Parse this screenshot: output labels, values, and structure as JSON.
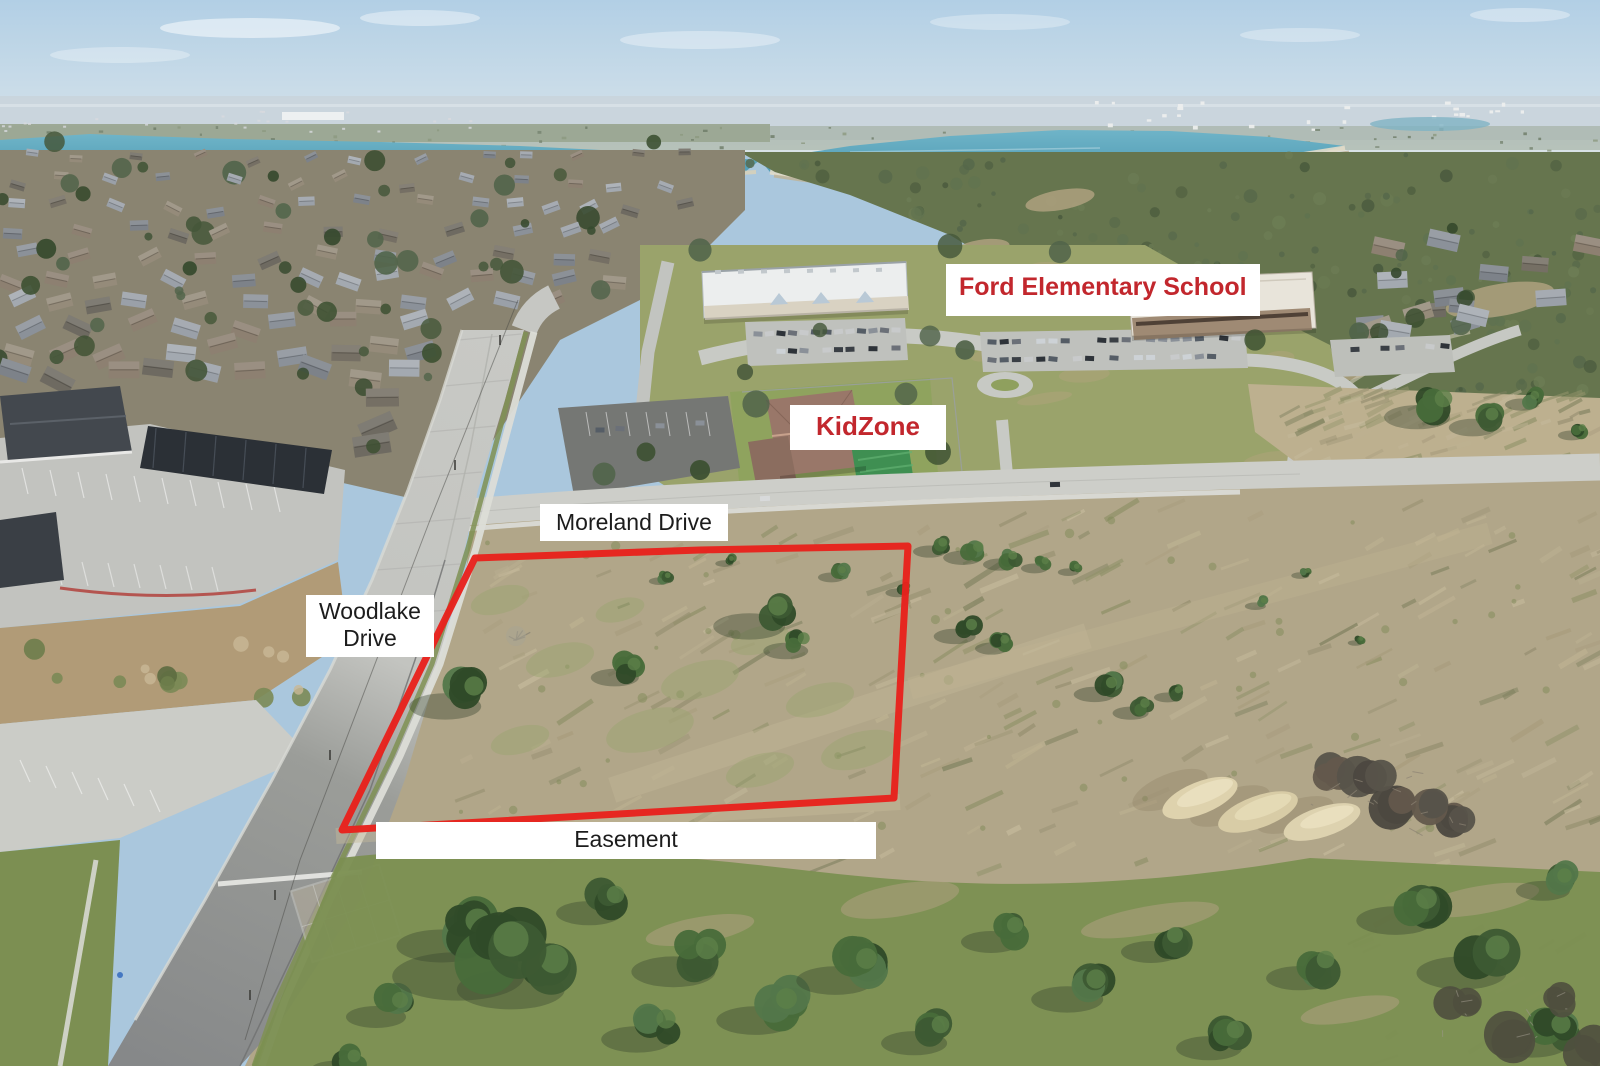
{
  "labels": {
    "school": {
      "text": "Ford Elementary School"
    },
    "kidzone": {
      "text": "KidZone"
    },
    "moreland": {
      "text": "Moreland Drive"
    },
    "woodlake": {
      "line1": "Woodlake",
      "line2": "Drive"
    },
    "easement": {
      "text": "Easement"
    }
  },
  "colors": {
    "school_label_text": "#c2272d",
    "kidzone_label_text": "#c2272d",
    "street_label_text": "#1c1c1c",
    "label_background": "#ffffff",
    "property_boundary_outline": "#e8211c"
  }
}
